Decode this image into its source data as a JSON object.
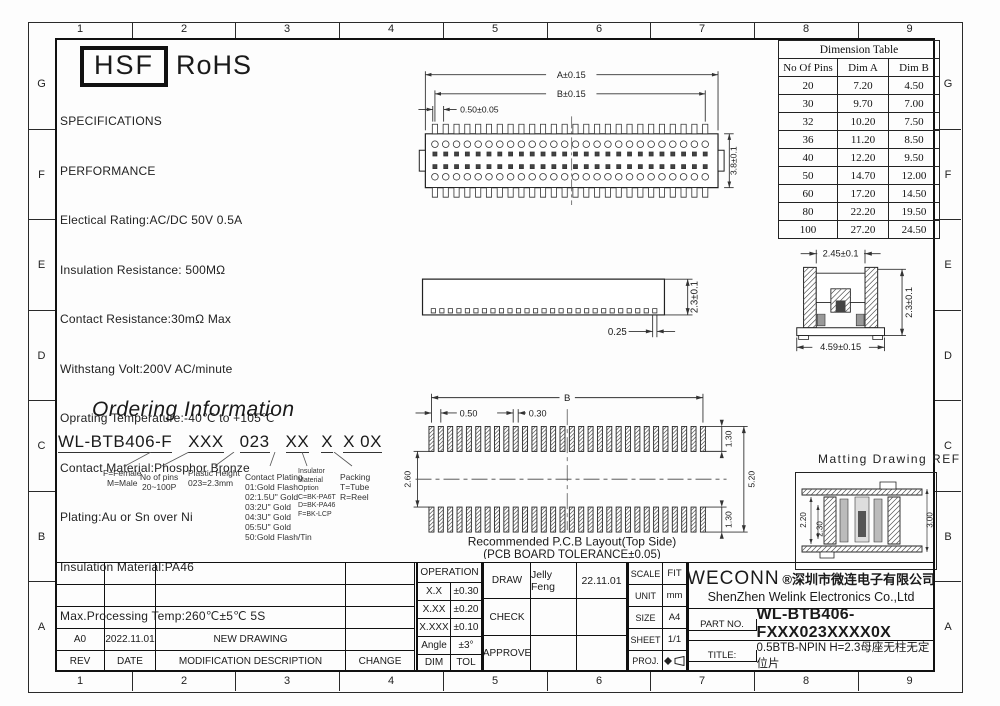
{
  "colors": {
    "line": "#1a1a1a",
    "paper": "#ffffff"
  },
  "zones": {
    "cols": [
      "1",
      "2",
      "3",
      "4",
      "5",
      "6",
      "7",
      "8",
      "9"
    ],
    "rows": [
      "G",
      "F",
      "E",
      "D",
      "C",
      "B",
      "A"
    ]
  },
  "logo": {
    "hsf": "HSF",
    "rohs": "RoHS"
  },
  "specs": {
    "lines": [
      "SPECIFICATIONS",
      "PERFORMANCE",
      "Electical Rating:AC/DC 50V 0.5A",
      "Insulation Resistance: 500MΩ",
      "Contact Resistance:30mΩ Max",
      "Withstang Volt:200V AC/minute",
      "Oprating Temperature:-40℃ to +105℃",
      "Contact Material:Phosphor Bronze",
      "Plating:Au or Sn over Ni",
      "Insulation Material:PA46",
      "Max.Processing Temp:260℃±5℃ 5S"
    ]
  },
  "dimension_table": {
    "title": "Dimension Table",
    "columns": [
      "No Of Pins",
      "Dim A",
      "Dim B"
    ],
    "rows": [
      [
        "20",
        "7.20",
        "4.50"
      ],
      [
        "30",
        "9.70",
        "7.00"
      ],
      [
        "32",
        "10.20",
        "7.50"
      ],
      [
        "36",
        "11.20",
        "8.50"
      ],
      [
        "40",
        "12.20",
        "9.50"
      ],
      [
        "50",
        "14.70",
        "12.00"
      ],
      [
        "60",
        "17.20",
        "14.50"
      ],
      [
        "80",
        "22.20",
        "19.50"
      ],
      [
        "100",
        "27.20",
        "24.50"
      ]
    ]
  },
  "top_view": {
    "dim_a": "A±0.15",
    "dim_b": "B±0.15",
    "dim_pitch": "0.50±0.05",
    "dim_height": "3.8±0.1"
  },
  "side_view": {
    "dim_height": "2.3±0.1",
    "dim_pin": "0.25"
  },
  "section_view": {
    "dim_top": "2.45±0.1",
    "dim_right": "2.3±0.1",
    "dim_bottom": "4.59±0.15"
  },
  "pcb_layout": {
    "dim_b": "B",
    "dim_pitch1": "0.50",
    "dim_pitch2": "0.30",
    "dim_pad_top": "1.30",
    "dim_span": "5.20",
    "dim_pad_bottom": "1.30",
    "dim_gap": "2.60",
    "caption1": "Recommended P.C.B Layout(Top Side)",
    "caption2": "(PCB BOARD TOLERANCE±0.05)"
  },
  "matting": {
    "title": "Matting Drawing REF",
    "dim_left_outer": "2.20",
    "dim_left_inner": "2.30",
    "dim_right": "3.00"
  },
  "ordering": {
    "title": "Ordering Information",
    "segments": [
      "WL-BTB406-F",
      "XXX",
      "023",
      "XX",
      "X",
      "X 0X"
    ],
    "legend_gender": [
      "F=Female",
      "M=Male"
    ],
    "legend_pins": [
      "No of pins",
      "20~100P"
    ],
    "legend_height": [
      "Plastic Height",
      "023=2.3mm"
    ],
    "legend_plating": [
      "Contact Plating",
      "01:Gold Flash",
      "02:1.5U\" Gold",
      "03:2U\" Gold",
      "04:3U\" Gold",
      "05:5U\" Gold",
      "50:Gold Flash/Tin"
    ],
    "legend_insulator": [
      "Insulator",
      "Material",
      "Option",
      "C=BK-PA6T",
      "D=BK-PA46",
      "F=BK-LCP"
    ],
    "legend_packing": [
      "Packing",
      "T=Tube",
      "R=Reel"
    ]
  },
  "revision": {
    "headers": [
      "REV",
      "DATE",
      "MODIFICATION DESCRIPTION",
      "CHANGE"
    ],
    "row": {
      "rev": "A0",
      "date": "2022.11.01",
      "desc": "NEW DRAWING",
      "change": ""
    }
  },
  "tolerance": {
    "title": "OPERATION",
    "rows": [
      [
        "X.X",
        "±0.30"
      ],
      [
        "X.XX",
        "±0.20"
      ],
      [
        "X.XXX",
        "±0.10"
      ],
      [
        "Angle",
        "±3°"
      ],
      [
        "DIM",
        "TOL"
      ]
    ]
  },
  "approval": {
    "draw": "DRAW",
    "draw_name": "Jelly Feng",
    "draw_date": "22.11.01",
    "check": "CHECK",
    "approve": "APPROVE"
  },
  "sheet": {
    "scale_label": "SCALE",
    "scale": "FIT",
    "unit_label": "UNIT",
    "unit": "mm",
    "size_label": "SIZE",
    "size": "A4",
    "sheet_label": "SHEET",
    "sheet": "1/1",
    "proj_label": "PROJ."
  },
  "company": {
    "logo": "WECONN",
    "cn": "®深圳市微连电子有限公司",
    "en": "ShenZhen Welink Electronics Co.,Ltd",
    "part_label": "PART NO.",
    "part_no": "WL-BTB406-FXXX023XXXX0X",
    "title_label": "TITLE:",
    "title": "0.5BTB-NPIN H=2.3母座无柱无定位片"
  }
}
